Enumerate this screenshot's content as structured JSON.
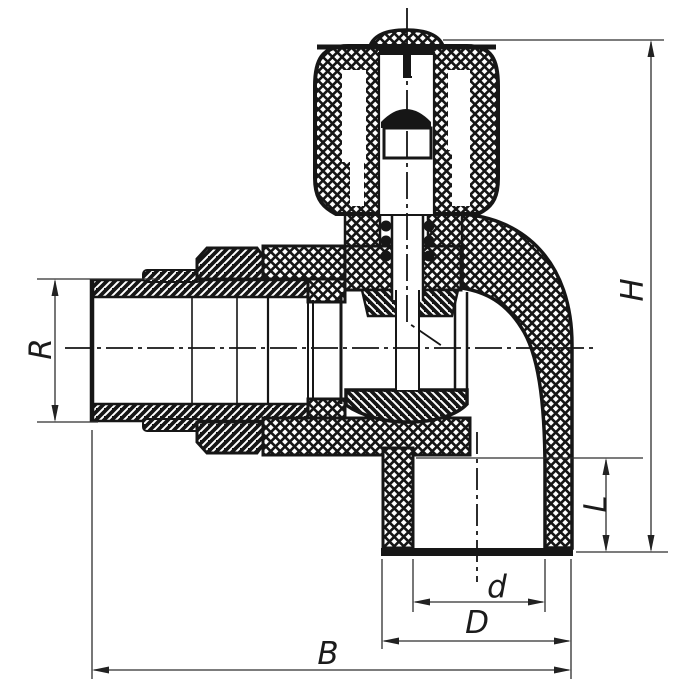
{
  "drawing": {
    "kind": "angle valve cross-section technical drawing",
    "background": "#ffffff",
    "line_color": "#161616",
    "dimension_color": "#2e2e2e",
    "labels": {
      "R": "R",
      "H": "H",
      "L": "L",
      "d": "d",
      "D": "D",
      "B": "B"
    },
    "dimensions": [
      {
        "label": "R",
        "axis": "vertical",
        "region": "left inlet thread"
      },
      {
        "label": "H",
        "axis": "vertical",
        "region": "overall height right side"
      },
      {
        "label": "L",
        "axis": "vertical",
        "region": "bottom socket depth"
      },
      {
        "label": "d",
        "axis": "horizontal",
        "region": "socket inner diameter"
      },
      {
        "label": "D",
        "axis": "horizontal",
        "region": "socket outer diameter"
      },
      {
        "label": "B",
        "axis": "horizontal",
        "region": "overall width bottom"
      }
    ]
  }
}
